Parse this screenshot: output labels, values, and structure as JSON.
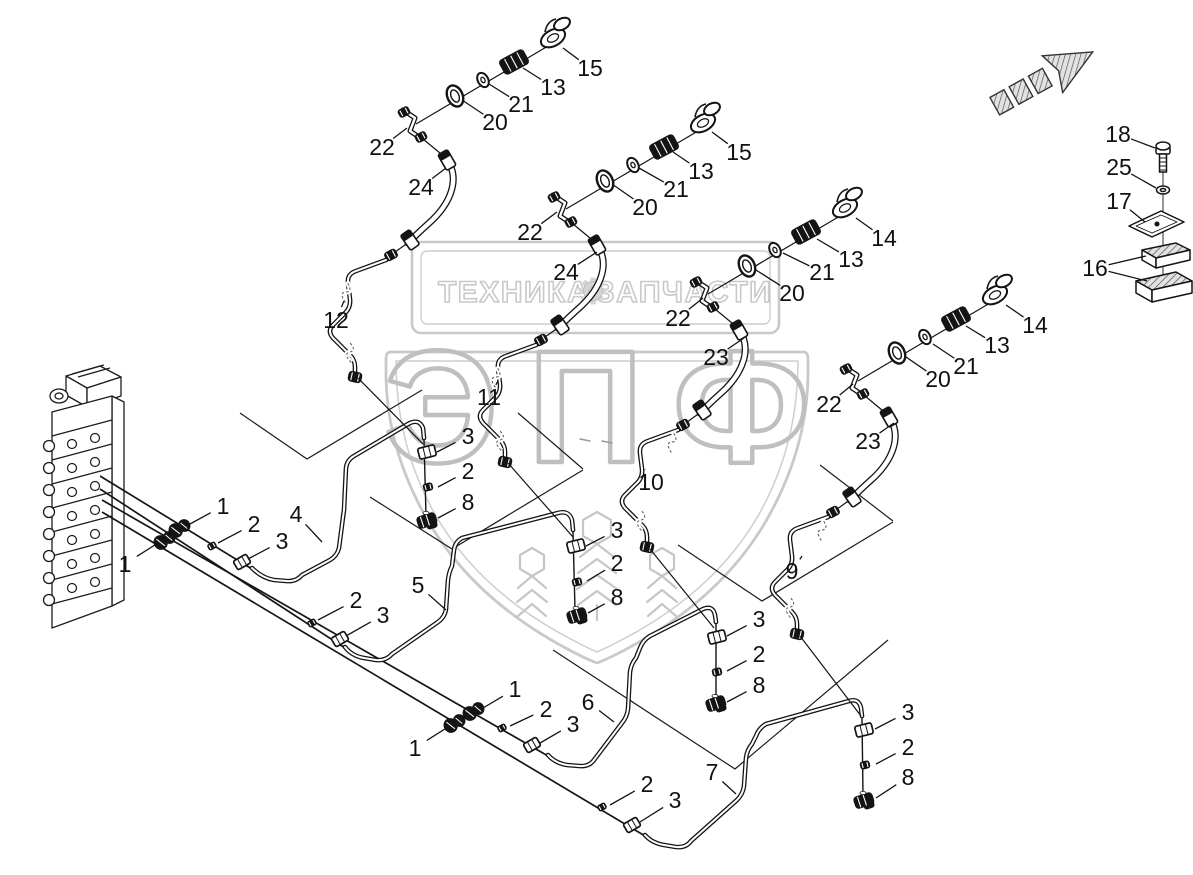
{
  "page": {
    "background": "#ffffff"
  },
  "watermark": {
    "banner_left": "ТЕХНИКА",
    "banner_right": "ЗАПЧАСТИ",
    "brand": "ЭПФ",
    "color": "#c9c9c9",
    "gear_icon": "gear-icon"
  },
  "diagram": {
    "ink": "#141414",
    "arrow_icon": "direction-arrow-icon",
    "labels": [
      {
        "t": "15",
        "x": 590,
        "y": 68,
        "leaders": [
          [
            563,
            48
          ]
        ]
      },
      {
        "t": "13",
        "x": 553,
        "y": 87,
        "leaders": [
          [
            523,
            68
          ]
        ]
      },
      {
        "t": "21",
        "x": 521,
        "y": 104,
        "leaders": [
          [
            489,
            84
          ]
        ]
      },
      {
        "t": "20",
        "x": 495,
        "y": 122,
        "leaders": [
          [
            462,
            100
          ]
        ]
      },
      {
        "t": "22",
        "x": 382,
        "y": 147,
        "leaders": [
          [
            407,
            128
          ]
        ]
      },
      {
        "t": "24",
        "x": 421,
        "y": 187,
        "leaders": [
          [
            446,
            168
          ]
        ]
      },
      {
        "t": "12",
        "x": 336,
        "y": 320,
        "leaders": [
          [
            344,
            301
          ]
        ]
      },
      {
        "t": "15",
        "x": 739,
        "y": 152,
        "leaders": [
          [
            712,
            132
          ]
        ]
      },
      {
        "t": "13",
        "x": 701,
        "y": 171,
        "leaders": [
          [
            673,
            152
          ]
        ]
      },
      {
        "t": "21",
        "x": 676,
        "y": 189,
        "leaders": [
          [
            639,
            168
          ]
        ]
      },
      {
        "t": "20",
        "x": 645,
        "y": 207,
        "leaders": [
          [
            612,
            184
          ]
        ]
      },
      {
        "t": "22",
        "x": 530,
        "y": 232,
        "leaders": [
          [
            557,
            212
          ]
        ]
      },
      {
        "t": "24",
        "x": 566,
        "y": 272,
        "leaders": [
          [
            597,
            252
          ]
        ]
      },
      {
        "t": "11",
        "x": 489,
        "y": 397,
        "leaders": [
          [
            498,
            381
          ]
        ]
      },
      {
        "t": "14",
        "x": 884,
        "y": 238,
        "leaders": [
          [
            856,
            218
          ]
        ]
      },
      {
        "t": "13",
        "x": 851,
        "y": 259,
        "leaders": [
          [
            817,
            239
          ]
        ]
      },
      {
        "t": "21",
        "x": 822,
        "y": 272,
        "leaders": [
          [
            783,
            253
          ]
        ]
      },
      {
        "t": "20",
        "x": 792,
        "y": 293,
        "leaders": [
          [
            756,
            270
          ]
        ]
      },
      {
        "t": "22",
        "x": 678,
        "y": 318,
        "leaders": [
          [
            703,
            298
          ]
        ]
      },
      {
        "t": "23",
        "x": 716,
        "y": 357,
        "leaders": [
          [
            744,
            338
          ]
        ]
      },
      {
        "t": "10",
        "x": 651,
        "y": 482,
        "leaders": [
          [
            645,
            470
          ]
        ]
      },
      {
        "t": "14",
        "x": 1035,
        "y": 325,
        "leaders": [
          [
            1006,
            305
          ]
        ]
      },
      {
        "t": "13",
        "x": 997,
        "y": 345,
        "leaders": [
          [
            966,
            326
          ]
        ]
      },
      {
        "t": "21",
        "x": 966,
        "y": 366,
        "leaders": [
          [
            933,
            344
          ]
        ]
      },
      {
        "t": "20",
        "x": 938,
        "y": 379,
        "leaders": [
          [
            906,
            357
          ]
        ]
      },
      {
        "t": "22",
        "x": 829,
        "y": 404,
        "leaders": [
          [
            853,
            384
          ]
        ]
      },
      {
        "t": "23",
        "x": 868,
        "y": 441,
        "leaders": [
          [
            894,
            423
          ]
        ]
      },
      {
        "t": "9",
        "x": 792,
        "y": 571,
        "leaders": [
          [
            802,
            556
          ]
        ]
      },
      {
        "t": "18",
        "x": 1118,
        "y": 134,
        "leaders": [
          [
            1155,
            148
          ]
        ]
      },
      {
        "t": "25",
        "x": 1119,
        "y": 167,
        "leaders": [
          [
            1156,
            188
          ]
        ]
      },
      {
        "t": "17",
        "x": 1119,
        "y": 201,
        "leaders": [
          [
            1145,
            222
          ]
        ]
      },
      {
        "t": "16",
        "x": 1095,
        "y": 268,
        "leaders": [
          [
            1146,
            256
          ],
          [
            1147,
            281
          ]
        ]
      },
      {
        "t": "1",
        "x": 223,
        "y": 506,
        "leaders": [
          [
            190,
            524
          ]
        ]
      },
      {
        "t": "2",
        "x": 254,
        "y": 524,
        "leaders": [
          [
            218,
            543
          ]
        ]
      },
      {
        "t": "3",
        "x": 282,
        "y": 541,
        "leaders": [
          [
            248,
            559
          ]
        ]
      },
      {
        "t": "4",
        "x": 296,
        "y": 514,
        "leaders": [
          [
            322,
            542
          ]
        ]
      },
      {
        "t": "1",
        "x": 125,
        "y": 564,
        "leaders": [
          [
            158,
            543
          ]
        ]
      },
      {
        "t": "2",
        "x": 356,
        "y": 600,
        "leaders": [
          [
            318,
            620
          ]
        ]
      },
      {
        "t": "3",
        "x": 383,
        "y": 615,
        "leaders": [
          [
            346,
            636
          ]
        ]
      },
      {
        "t": "5",
        "x": 418,
        "y": 585,
        "leaders": [
          [
            446,
            610
          ]
        ]
      },
      {
        "t": "3",
        "x": 468,
        "y": 436,
        "leaders": [
          [
            437,
            452
          ]
        ]
      },
      {
        "t": "2",
        "x": 468,
        "y": 471,
        "leaders": [
          [
            438,
            487
          ]
        ]
      },
      {
        "t": "8",
        "x": 468,
        "y": 502,
        "leaders": [
          [
            438,
            518
          ]
        ]
      },
      {
        "t": "3",
        "x": 617,
        "y": 530,
        "leaders": [
          [
            586,
            546
          ]
        ]
      },
      {
        "t": "2",
        "x": 617,
        "y": 563,
        "leaders": [
          [
            587,
            581
          ]
        ]
      },
      {
        "t": "8",
        "x": 617,
        "y": 597,
        "leaders": [
          [
            588,
            613
          ]
        ]
      },
      {
        "t": "3",
        "x": 759,
        "y": 619,
        "leaders": [
          [
            727,
            636
          ]
        ]
      },
      {
        "t": "2",
        "x": 759,
        "y": 654,
        "leaders": [
          [
            727,
            671
          ]
        ]
      },
      {
        "t": "8",
        "x": 759,
        "y": 685,
        "leaders": [
          [
            727,
            702
          ]
        ]
      },
      {
        "t": "3",
        "x": 908,
        "y": 712,
        "leaders": [
          [
            875,
            729
          ]
        ]
      },
      {
        "t": "2",
        "x": 908,
        "y": 747,
        "leaders": [
          [
            876,
            764
          ]
        ]
      },
      {
        "t": "8",
        "x": 908,
        "y": 777,
        "leaders": [
          [
            876,
            798
          ]
        ]
      },
      {
        "t": "1",
        "x": 515,
        "y": 689,
        "leaders": [
          [
            483,
            708
          ]
        ]
      },
      {
        "t": "2",
        "x": 546,
        "y": 709,
        "leaders": [
          [
            510,
            726
          ]
        ]
      },
      {
        "t": "3",
        "x": 573,
        "y": 724,
        "leaders": [
          [
            540,
            743
          ]
        ]
      },
      {
        "t": "1",
        "x": 415,
        "y": 748,
        "leaders": [
          [
            448,
            727
          ]
        ]
      },
      {
        "t": "6",
        "x": 588,
        "y": 702,
        "leaders": [
          [
            614,
            722
          ]
        ]
      },
      {
        "t": "2",
        "x": 647,
        "y": 784,
        "leaders": [
          [
            610,
            805
          ]
        ]
      },
      {
        "t": "3",
        "x": 675,
        "y": 800,
        "leaders": [
          [
            640,
            822
          ]
        ]
      },
      {
        "t": "7",
        "x": 712,
        "y": 772,
        "leaders": [
          [
            736,
            794
          ]
        ]
      }
    ]
  }
}
